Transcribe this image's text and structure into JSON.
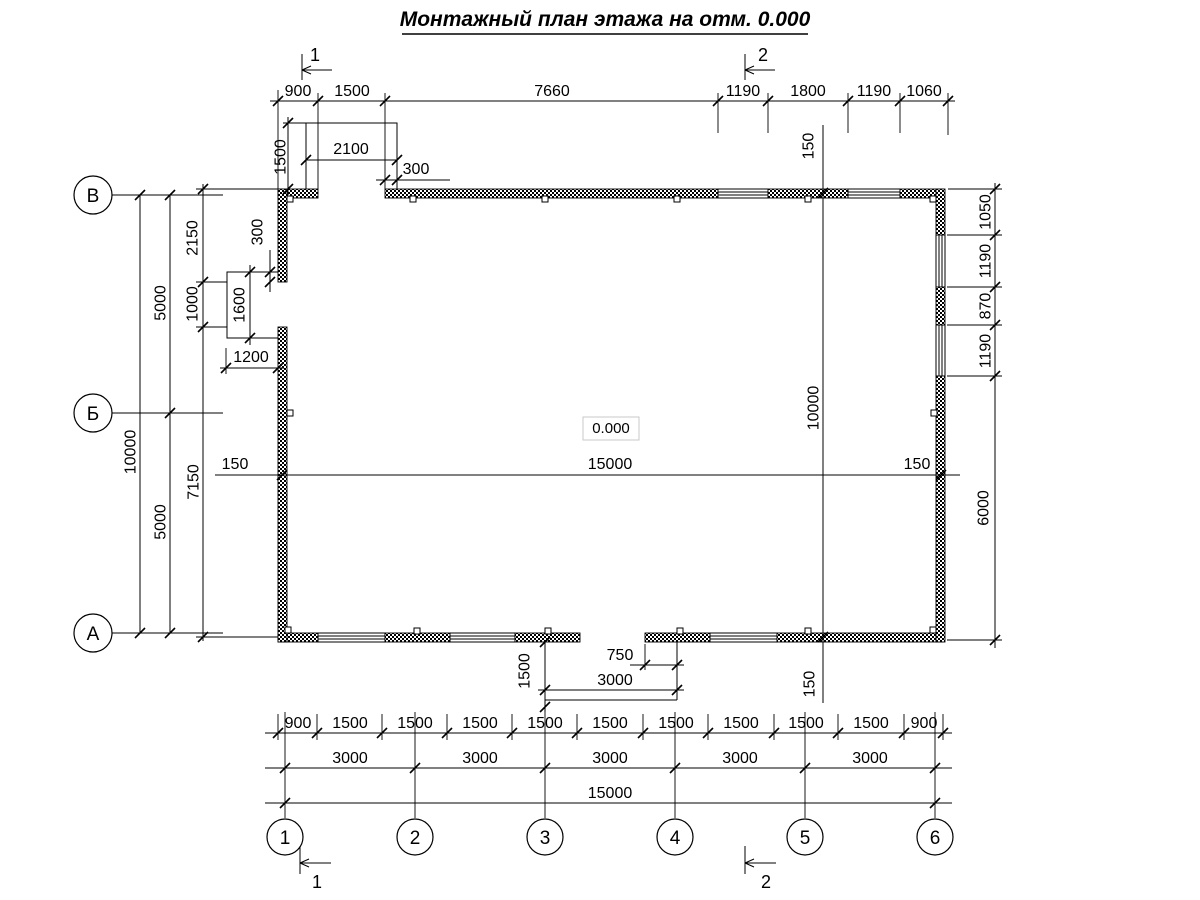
{
  "title": {
    "text": "Монтажный план этажа на отм. 0.000"
  },
  "elevation": "0.000",
  "axes": {
    "rows": [
      "В",
      "Б",
      "А"
    ],
    "cols": [
      "1",
      "2",
      "3",
      "4",
      "5",
      "6"
    ]
  },
  "sections": {
    "one": "1",
    "two": "2"
  },
  "dims": {
    "top": [
      "900",
      "1500",
      "7660",
      "1190",
      "1800",
      "1190",
      "1060"
    ],
    "top_door": {
      "height": "1500",
      "width": "2100",
      "pier": "300"
    },
    "left_chain": [
      "2150",
      "1000",
      "7150"
    ],
    "left_mid": [
      "5000",
      "5000"
    ],
    "left_total": "10000",
    "left_door": {
      "width": "1600",
      "pier": "300",
      "offset": "1200"
    },
    "width_line": {
      "left": "150",
      "mid": "15000",
      "right": "150"
    },
    "height_line": {
      "top": "150",
      "mid": "10000",
      "bottom": "150"
    },
    "right_chain": [
      "1050",
      "1190",
      "870",
      "1190",
      "6000"
    ],
    "porch": {
      "depth": "1500",
      "width": "3000",
      "offset": "750"
    },
    "bottom_row1": [
      "900",
      "1500",
      "1500",
      "1500",
      "1500",
      "1500",
      "1500",
      "1500",
      "1500",
      "1500",
      "900"
    ],
    "bottom_row2": [
      "3000",
      "3000",
      "3000",
      "3000",
      "3000"
    ],
    "bottom_total": "15000"
  }
}
